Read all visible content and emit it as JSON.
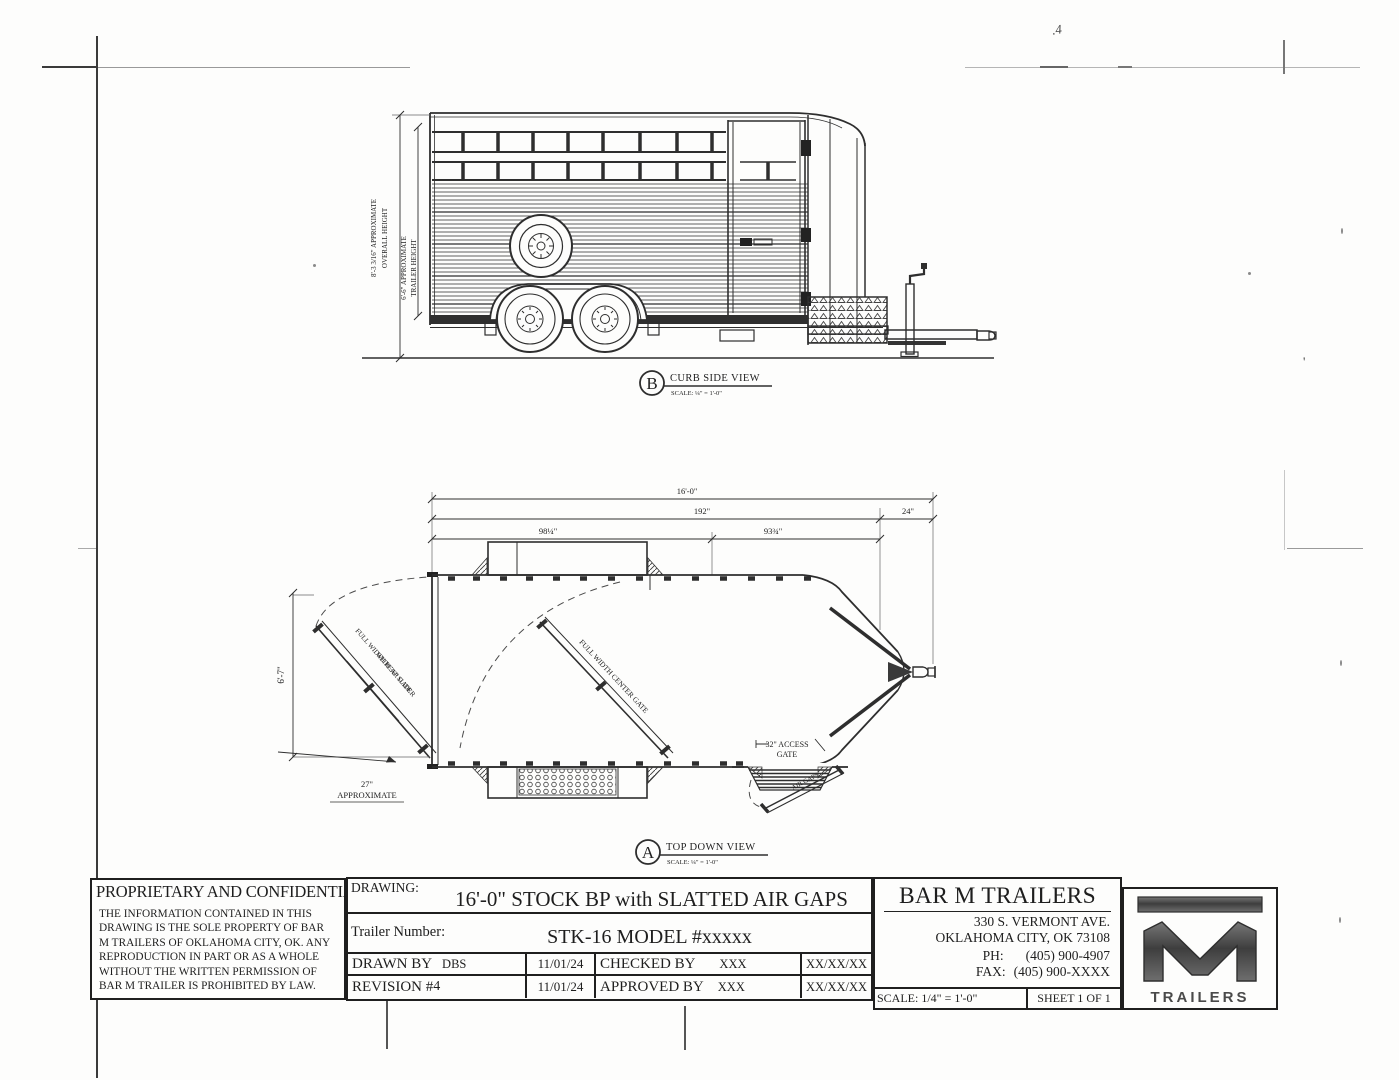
{
  "artifacts": {
    "handwritten_mark": ".4",
    "stray_tick": "'"
  },
  "side_view": {
    "marker_letter": "B",
    "view_title": "CURB SIDE VIEW",
    "view_scale": "SCALE: ¼\" = 1'-0\"",
    "overall_height_line1": "8'-3 3/16\" APPROXIMATE",
    "overall_height_line2": "OVERALL HEIGHT",
    "trailer_height_line1": "6'-6\" APPROXIMATE",
    "trailer_height_line2": "TRAILER HEIGHT"
  },
  "top_view": {
    "marker_letter": "A",
    "view_title": "TOP DOWN VIEW",
    "view_scale": "SCALE: ¼\" = 1'-0\"",
    "dim_overall_length": "16'-0\"",
    "dim_box_length": "192\"",
    "dim_nose_length": "24\"",
    "dim_rear_section": "98¼\"",
    "dim_front_section": "93¾\"",
    "dim_width": "6'-7\"",
    "dim_rear_swing_line1": "27\"",
    "dim_rear_swing_line2": "APPROXIMATE",
    "rear_gate_label_line1": "FULL WIDTH REAR GATE",
    "rear_gate_label_line2": "WITH 36\" SLIDER",
    "center_gate_label": "FULL WIDTH CENTER GATE",
    "access_gate_label_line1": "32\" ACCESS",
    "access_gate_label_line2": "GATE",
    "air_gaps_label": "AIR GAPS"
  },
  "title_block": {
    "proprietary_title": "PROPRIETARY AND CONFIDENTIAL",
    "proprietary_body": "THE INFORMATION CONTAINED IN THIS\nDRAWING IS THE SOLE PROPERTY OF BAR\nM TRAILERS OF OKLAHOMA CITY, OK. ANY\nREPRODUCTION IN PART OR AS A WHOLE\nWITHOUT THE WRITTEN PERMISSION OF\nBAR M TRAILER IS PROHIBITED BY LAW.",
    "drawing_label": "DRAWING:",
    "drawing_title": "16'-0\" STOCK BP with SLATTED AIR GAPS",
    "trailer_number_label": "Trailer Number:",
    "trailer_number_value": "STK-16 MODEL #xxxxx",
    "drawn_by_label": "DRAWN BY",
    "drawn_by_value": "DBS",
    "drawn_date": "11/01/24",
    "checked_by_label": "CHECKED BY",
    "checked_by_value": "XXX",
    "checked_date": "XX/XX/XX",
    "revision_label": "REVISION #",
    "revision_value": "4",
    "revision_date": "11/01/24",
    "approved_by_label": "APPROVED BY",
    "approved_by_value": "XXX",
    "approved_date": "XX/XX/XX",
    "company_name": "BAR M TRAILERS",
    "company_address1": "330 S. VERMONT AVE.",
    "company_address2": "OKLAHOMA CITY, OK 73108",
    "phone_label": "PH:",
    "phone_value": "(405) 900-4907",
    "fax_label": "FAX:",
    "fax_value": "(405) 900-XXXX",
    "scale_text": "SCALE: 1/4\" = 1'-0\"",
    "sheet_text": "SHEET 1 OF 1",
    "logo_wordmark": "TRAILERS"
  }
}
